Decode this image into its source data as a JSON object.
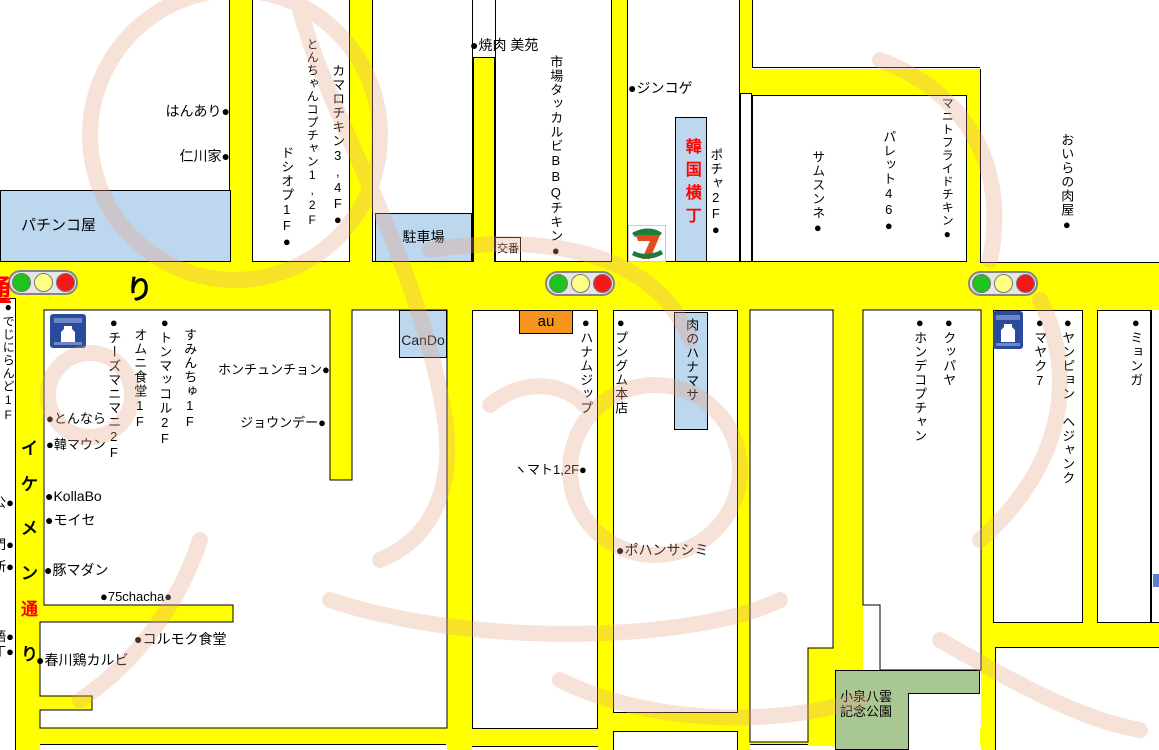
{
  "colors": {
    "road_yellow": "#FFFF00",
    "box_blue": "#BDD7EE",
    "park_green": "#A9C793",
    "au_orange": "#F7941D",
    "accent_red": "#FF0000",
    "lawson_blue": "#2A4B9B",
    "watermark_pink": "#EBB29A"
  },
  "roads": {
    "main_left_char": "通",
    "main_right_char": "り",
    "ikemen_chars": [
      "イ",
      "ケ",
      "メ",
      "ン",
      "通",
      "り"
    ]
  },
  "boxes": {
    "pachinko": "パチンコ屋",
    "parking": "駐車場",
    "koban": "交番",
    "cando": "CanDo",
    "au": "au",
    "yokocho": "韓国横丁",
    "hanamasa": "肉のハナマサ",
    "park_line1": "小泉八雲",
    "park_line2": "記念公園"
  },
  "icons": {
    "lawson": "LAWSON",
    "seven_eleven": "7"
  },
  "shops_top": {
    "hanari": "はんあり●",
    "incheon": "仁川家●",
    "doshiop": "ドシオプ1F●",
    "tonchan": "とんちゃんコプチャン1,2F",
    "kamaro": "カマロチキン3,4F●",
    "yakiniku": "●焼肉 美苑",
    "ichiba": "市場タッカルビBBQチキン●",
    "jinkoge": "●ジンコゲ",
    "pocha": "ポチャ2F●",
    "samsunne": "サムスンネ●",
    "palette": "パレット46●",
    "manito": "マニトフライドチキン●",
    "oira": "おいらの肉屋●"
  },
  "shops_left_edge": {
    "dejini": "●でじにらんど1F",
    "cut1": "公●",
    "cut2": "門●",
    "cut3": "所●",
    "cut4": "語●",
    "cut5": "丁●"
  },
  "shops_block_west": {
    "cheese": "●チーズマニマニ2F",
    "omuni": "オムニ食堂1F",
    "tonmakkol": "●トンマッコル2F",
    "sumin": "すみんちゅ1F",
    "tonnara": "●とんなら",
    "hanmaun": "●韓マウン",
    "honchun": "ホンチュンチョン●",
    "joun": "ジョウンデー●",
    "kollabo": "●KollaBo",
    "moise": "●モイセ",
    "butamadan": "●豚マダン",
    "chacha": "●75chacha●",
    "kolmok": "●コルモク食堂",
    "chuncheon": "●春川鶏カルビ"
  },
  "shops_center": {
    "hanamu": "●ハナムジップ",
    "mato": "ヽマト1,2F●",
    "pungmu": "●プングム本店",
    "pohan": "●ポハンサシミ"
  },
  "shops_east": {
    "kuppaya": "●クッパヤ",
    "hondae": "●ホンデコプチャン",
    "mayak": "●マヤク7",
    "yangpyon": "●ヤンピョン　ヘジャンク",
    "myonga": "●ミョンガ"
  }
}
